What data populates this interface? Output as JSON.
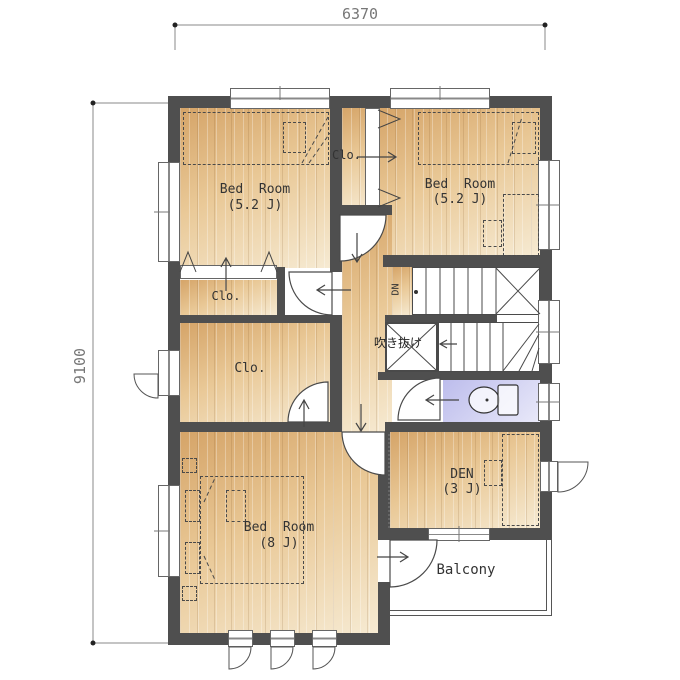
{
  "title": "second-floor-plan",
  "dimensions": {
    "top": "6370",
    "left": "9100"
  },
  "rooms": {
    "bedroom_top_left": {
      "name": "Bed  Room",
      "size": "(5.2 J)"
    },
    "bedroom_top_right": {
      "name": "Bed  Room",
      "size": "(5.2 J)"
    },
    "bedroom_bottom": {
      "name": "Bed  Room",
      "size": "(8 J)"
    },
    "den": {
      "name": "DEN",
      "size": "(3 J)"
    },
    "closet_top_right": {
      "label": "Clo."
    },
    "closet_small": {
      "label": "Clo."
    },
    "closet_walkin": {
      "label": "Clo."
    },
    "balcony": {
      "label": "Balcony"
    },
    "void": {
      "label": "吹き抜け"
    },
    "stairs": {
      "label": "DN"
    }
  },
  "colors": {
    "wall": "#4f4f4f",
    "wood_dark": "#d5a468",
    "wood_light": "#f6ead2",
    "toilet": "#bcbcec",
    "line": "#4a4a4a"
  }
}
